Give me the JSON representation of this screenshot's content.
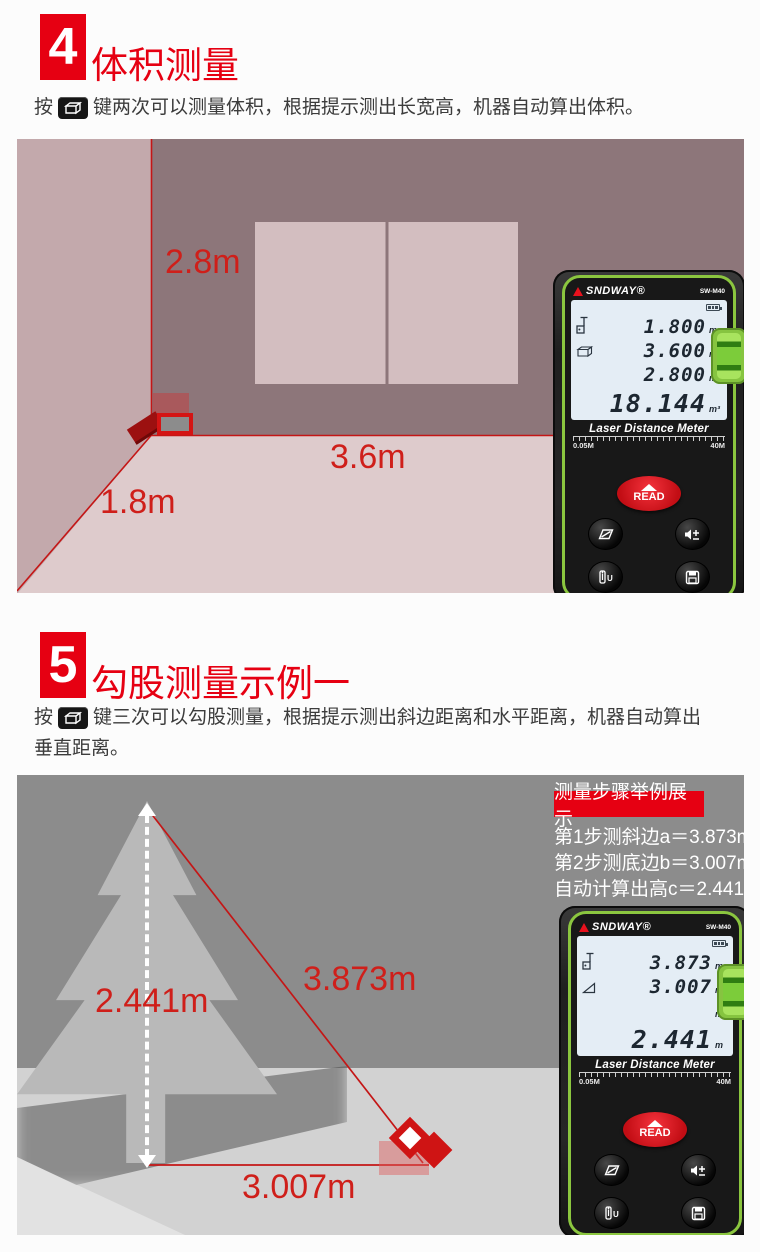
{
  "palette": {
    "accent_red": "#e60012",
    "dim_label_red": "#cf1f1a",
    "laser_line_red": "#c41616",
    "room_left_wall": "#c3a9ac",
    "room_back_wall": "#8d767a",
    "room_floor": "#decbcc",
    "window_pane": "#d3bec0",
    "scene2_background": "#8c8c8c",
    "scene2_ground": "#d2d2d2",
    "tree_gray": "#b9b9b9",
    "device_green_accent": "#8bc63f",
    "lcd_background": "#e4edf5"
  },
  "icons": {
    "inline_key": "volume-key-button (black key with white cuboid)",
    "lcd_row1": "laser-target-icon",
    "lcd_row2_volume": "cuboid-icon",
    "lcd_row2_pyth": "right-triangle-icon",
    "device_buttons": [
      "area-measure-icon",
      "speaker-plus-minus-icon",
      "unit-reference-icon",
      "save-icon"
    ],
    "misc": [
      "battery-icon",
      "bubble-level",
      "read-triangle"
    ]
  },
  "sections": [
    {
      "badge": "4",
      "title": "体积测量",
      "desc_prefix": "按",
      "desc_suffix": "键两次可以测量体积，根据提示测出长宽高，机器自动算出体积。",
      "labels": {
        "height": "2.8m",
        "width": "3.6m",
        "depth": "1.8m"
      }
    },
    {
      "badge": "5",
      "title": "勾股测量示例一",
      "desc_prefix": "按",
      "desc_suffix": "键三次可以勾股测量，根据提示测出斜边距离和水平距离，机器自动算出",
      "desc_line2": "垂直距离。",
      "labels": {
        "height": "2.441m",
        "hypotenuse": "3.873m",
        "base": "3.007m"
      },
      "info_box": {
        "title": "测量步骤举例展示",
        "lines": [
          "第1步测斜边a＝3.873m",
          "第2步测底边b＝3.007m",
          "自动计算出高c＝2.441m"
        ]
      }
    }
  ],
  "devices": [
    {
      "brand": "SNDWAY®",
      "model": "SW-M40",
      "rows": [
        {
          "value": "1.800",
          "unit": "m"
        },
        {
          "value": "3.600",
          "unit": "m"
        },
        {
          "value": "2.800",
          "unit": "m"
        },
        {
          "value": "18.144",
          "unit": "m³"
        }
      ],
      "footer": "Laser Distance Meter",
      "range_min": "0.05M",
      "range_max": "40M",
      "read_label": "READ"
    },
    {
      "brand": "SNDWAY®",
      "model": "SW-M40",
      "rows": [
        {
          "value": "3.873",
          "unit": "m"
        },
        {
          "value": "3.007",
          "unit": "m"
        },
        {
          "value": "",
          "unit": "m"
        },
        {
          "value": "2.441",
          "unit": "m"
        }
      ],
      "footer": "Laser Distance Meter",
      "range_min": "0.05M",
      "range_max": "40M",
      "read_label": "READ"
    }
  ]
}
